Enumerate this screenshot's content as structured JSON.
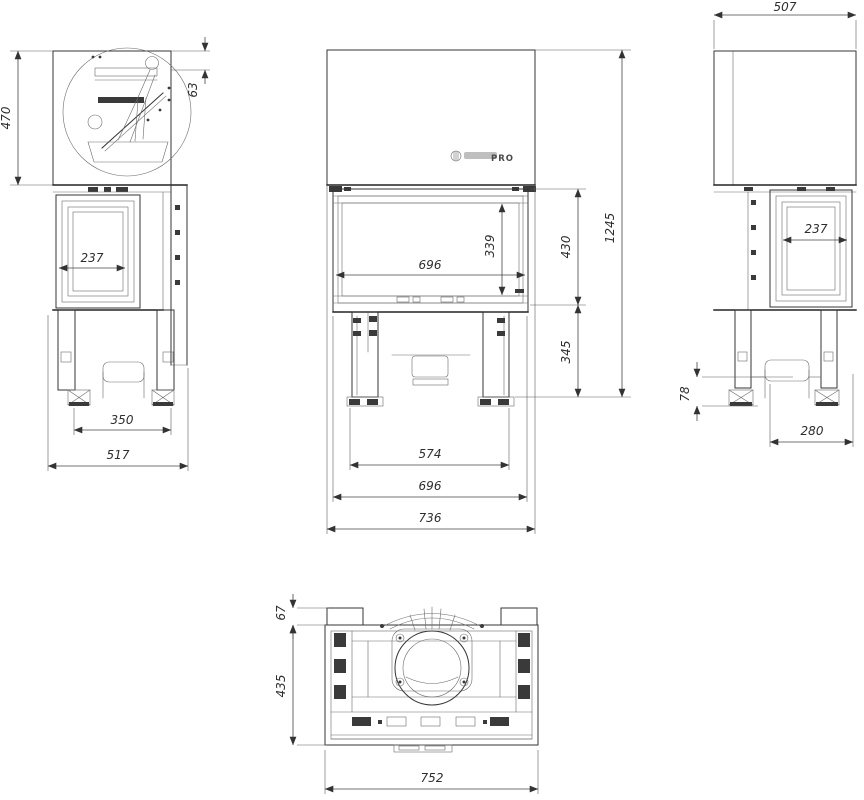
{
  "colors": {
    "background": "#ffffff",
    "line": "#3a3a3a",
    "dim_text": "#2e2e2e"
  },
  "brand": {
    "wordmark_suffix": "PRO"
  },
  "dimensions": {
    "side_left": {
      "hood_height": "470",
      "top_offset": "63",
      "glass_width": "237",
      "foot_spacing": "350",
      "overall_depth": "517"
    },
    "front": {
      "glass_width": "696",
      "glass_height": "339",
      "door_zone_height": "430",
      "overall_height": "1245",
      "base_zone_height": "345",
      "leg_span": "574",
      "body_width": "696",
      "overall_width": "736"
    },
    "side_right": {
      "overall_depth": "507",
      "glass_width": "237",
      "foot_height": "78",
      "base_depth": "280"
    },
    "top": {
      "front_offset": "67",
      "body_depth": "435",
      "body_width": "752"
    }
  }
}
